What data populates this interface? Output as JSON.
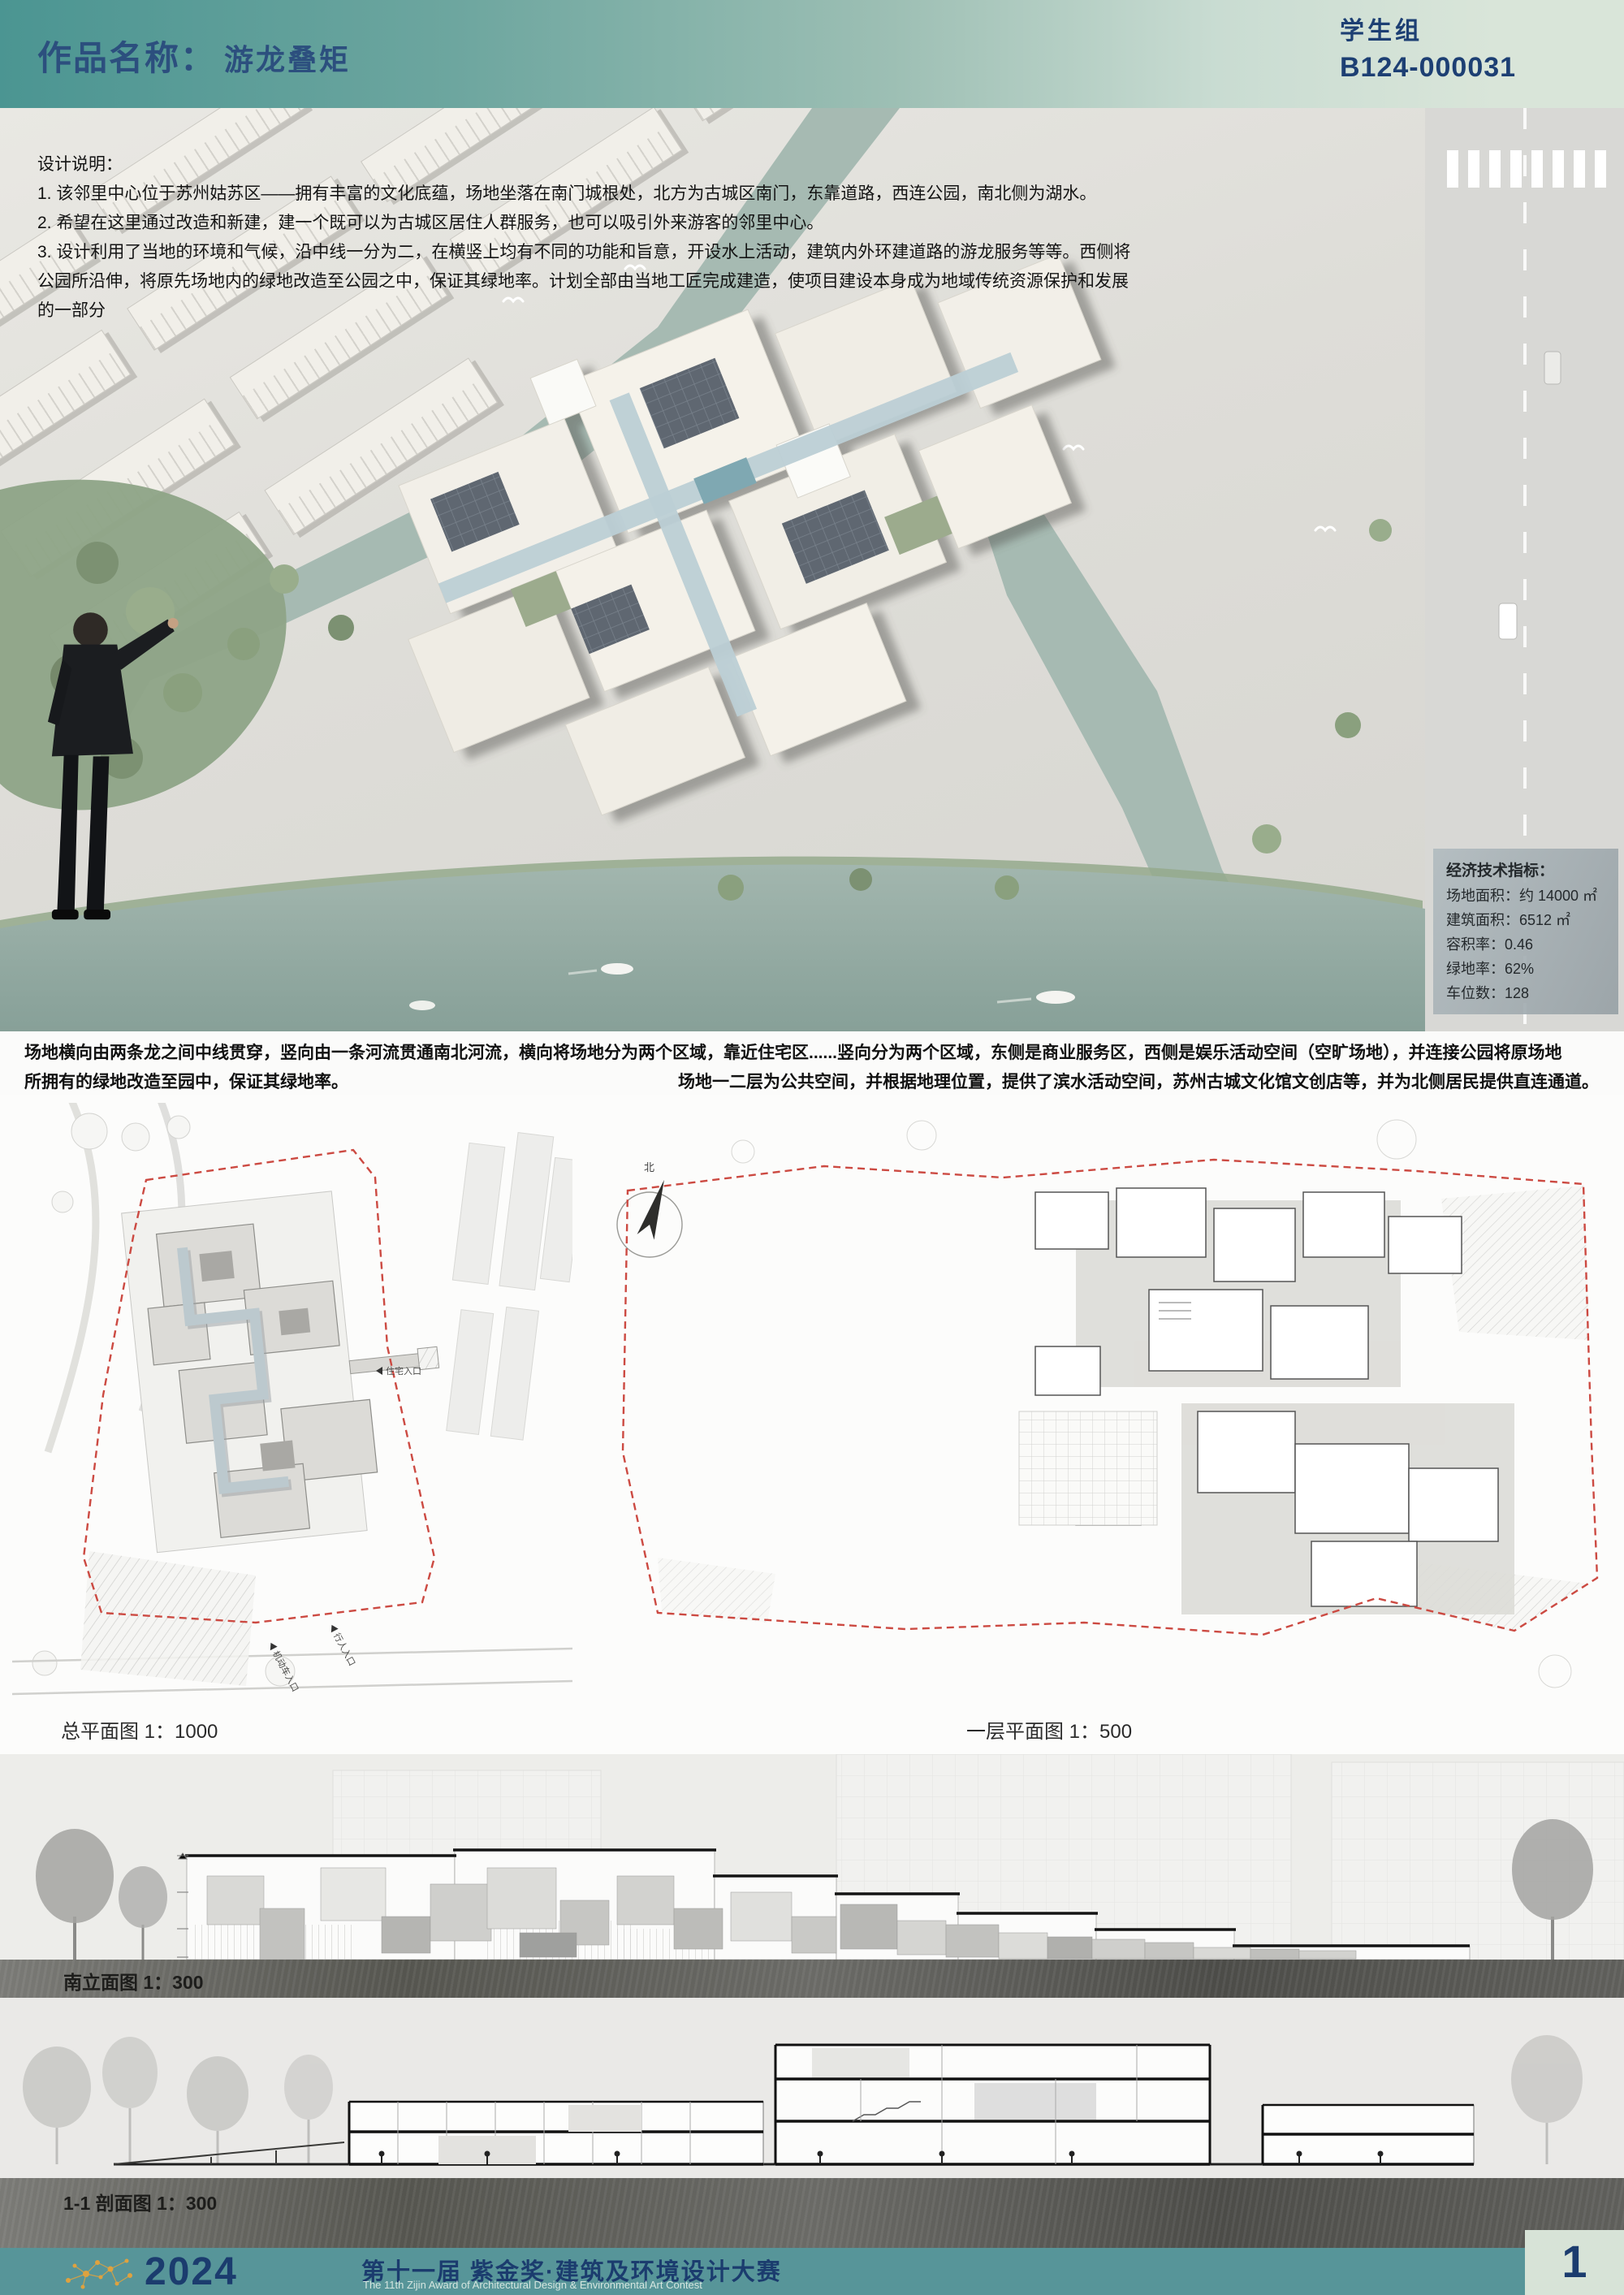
{
  "header": {
    "label": "作品名称：",
    "title": "游龙叠矩",
    "group": "学生组",
    "code": "B124-000031"
  },
  "design_notes": {
    "heading": "设计说明：",
    "lines": [
      "1. 该邻里中心位于苏州姑苏区——拥有丰富的文化底蕴，场地坐落在南门城根处，北方为古城区南门，东靠道路，西连公园，南北侧为湖水。",
      "2. 希望在这里通过改造和新建，建一个既可以为古城区居住人群服务，也可以吸引外来游客的邻里中心。",
      "3. 设计利用了当地的环境和气候，沿中线一分为二，在横竖上均有不同的功能和旨意，开设水上活动，建筑内外环建道路的游龙服务等等。西侧将",
      "公园所沿伸，将原先场地内的绿地改造至公园之中，保证其绿地率。计划全部由当地工匠完成建造，使项目建设本身成为地域传统资源保护和发展",
      "的一部分"
    ]
  },
  "indicators": {
    "title": "经济技术指标：",
    "rows": [
      "场地面积：约 14000 ㎡",
      "建筑面积：6512 ㎡",
      "容积率：0.46",
      "绿地率：62%",
      "车位数：128"
    ]
  },
  "site_text": {
    "line1": "场地横向由两条龙之间中线贯穿，竖向由一条河流贯通南北河流，横向将场地分为两个区域，靠近住宅区......竖向分为两个区域，东侧是商业服务区，西侧是娱乐活动空间（空旷场地），并连接公园将原场地",
    "line2_left": "所拥有的绿地改造至园中，保证其绿地率。",
    "line2_right": "场地一二层为公共空间，并根据地理位置，提供了滨水活动空间，苏州古城文化馆文创店等，并为北侧居民提供直连通道。"
  },
  "plans": {
    "site_plan_label": "总平面图 1：1000",
    "floor_plan_label": "一层平面图 1：500",
    "annotations": {
      "north": "北",
      "residential_entrance": "住宅入口",
      "pedestrian_entrance": "行人入口",
      "vehicle_entrance": "机动车入口"
    }
  },
  "elevation": {
    "label": "南立面图 1：300"
  },
  "section": {
    "label": "1-1 剖面图 1：300"
  },
  "footer": {
    "year": "2024",
    "title_cn": "第十一届 紫金奖·建筑及环境设计大赛",
    "title_en": "The 11th Zijin Award of Architectural Design & Environmental Art Contest",
    "page": "1"
  },
  "colors": {
    "header_teal": "#4b9592",
    "panel_green": "#d9e5d9",
    "navy": "#1b3c6e",
    "boundary_red": "#cc4a42",
    "water": "#9eb3ab",
    "footer_orange": "#dfa23f"
  }
}
